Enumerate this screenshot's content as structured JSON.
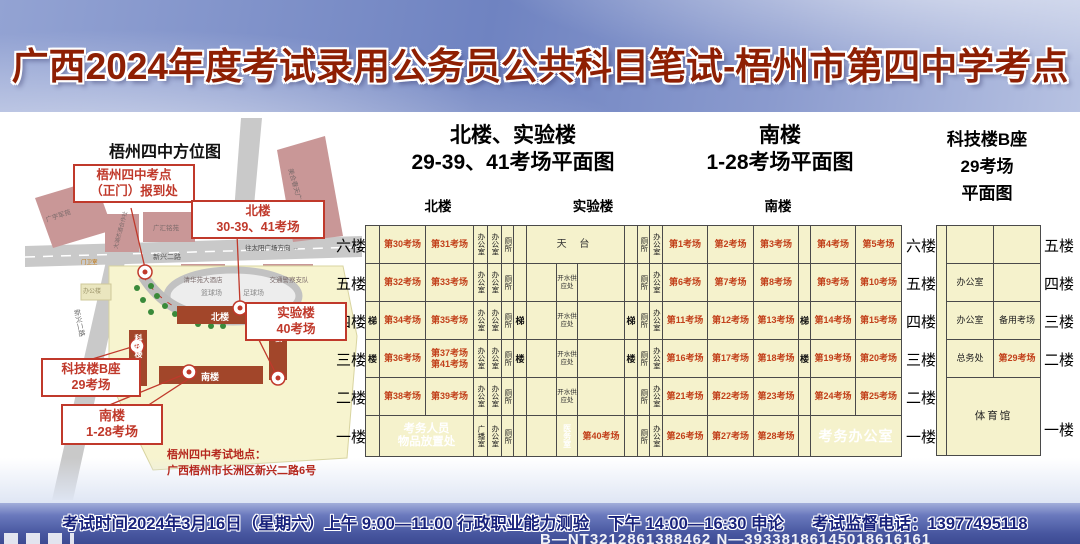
{
  "title": "广西2024年度考试录用公务员公共科目笔试-梧州市第四中学考点",
  "colors": {
    "banner_blue": "#6f83c1",
    "title_red": "#8e1f03",
    "cell_yellow": "#f5f2cc",
    "stair_green": "#d6e04e",
    "room_orange": "#c2401a",
    "admin_red": "#a2462a",
    "footer_blue": "#47569f",
    "callout_red": "#c0392b"
  },
  "map": {
    "title": "梧州四中方位图",
    "callouts": {
      "gate": {
        "l1": "梧州四中考点",
        "l2": "（正门）报到处"
      },
      "north": {
        "l1": "北楼",
        "l2": "30-39、41考场"
      },
      "lab": {
        "l1": "实验楼",
        "l2": "40考场"
      },
      "tech": {
        "l1": "科技楼B座",
        "l2": "29考场"
      },
      "south": {
        "l1": "南楼",
        "l2": "1-28考场"
      }
    },
    "buildings": {
      "b1": "广宇军苑",
      "b2": "大湖杰酒合作社",
      "b3": "广汇铭苑",
      "b4": "美合春天广场",
      "b5": "清华苑大酒店",
      "b6": "交通警察支队"
    },
    "campus": {
      "north": "北楼",
      "lab": "实验楼",
      "south": "南楼",
      "tech": "科技楼",
      "office": "办公楼",
      "gatehouse": "门卫室",
      "basketball": "篮球场",
      "football": "足球场"
    },
    "roads": {
      "r1": "新兴二路",
      "r2": "新兴二路",
      "r3": "往太阳广场方向",
      "arrow": "→"
    },
    "address": {
      "l1": "梧州四中考试地点：",
      "l2": "广西梧州市长洲区新兴二路6号"
    }
  },
  "plans": {
    "north_lab": {
      "line1": "北楼、实验楼",
      "line2": "29-39、41考场平面图",
      "sub_left": "北楼",
      "sub_right": "实验楼"
    },
    "south": {
      "line1": "南楼",
      "line2": "1-28考场平面图",
      "sub": "南楼"
    },
    "tech": {
      "line1": "科技楼B座",
      "line2": "29考场",
      "line3": "平面图"
    }
  },
  "floors": {
    "main": [
      "六楼",
      "五楼",
      "四楼",
      "三楼",
      "二楼",
      "一楼"
    ],
    "tech": [
      "五楼",
      "四楼",
      "三楼",
      "二楼",
      "一楼"
    ]
  },
  "strip": {
    "col_widths": [
      14,
      46,
      48,
      14,
      14,
      12,
      13,
      30,
      21,
      47,
      13,
      12,
      13,
      45,
      46,
      45,
      12,
      45,
      46
    ],
    "row_heights": [
      38,
      38,
      38,
      38,
      38,
      41
    ],
    "rows": [
      {
        "label": "六楼",
        "cells": [
          {
            "k": "st"
          },
          {
            "k": "room",
            "t": "第30考场"
          },
          {
            "k": "room",
            "t": "第31考场"
          },
          {
            "k": "v",
            "t": "办公室"
          },
          {
            "k": "v",
            "t": "办公室"
          },
          {
            "k": "v",
            "t": "厕所"
          },
          {
            "k": "st"
          },
          {
            "k": "terr",
            "t": "天 台",
            "cs": 3
          },
          {
            "k": "st"
          },
          {
            "k": "v",
            "t": "厕所"
          },
          {
            "k": "v",
            "t": "办公室"
          },
          {
            "k": "room",
            "t": "第1考场"
          },
          {
            "k": "room",
            "t": "第2考场"
          },
          {
            "k": "room",
            "t": "第3考场"
          },
          {
            "k": "st"
          },
          {
            "k": "room",
            "t": "第4考场"
          },
          {
            "k": "room",
            "t": "第5考场"
          }
        ]
      },
      {
        "label": "五楼",
        "cells": [
          {
            "k": "st"
          },
          {
            "k": "room",
            "t": "第32考场"
          },
          {
            "k": "room",
            "t": "第33考场"
          },
          {
            "k": "v",
            "t": "办公室"
          },
          {
            "k": "v",
            "t": "办公室"
          },
          {
            "k": "v",
            "t": "厕所"
          },
          {
            "k": "st"
          },
          {
            "k": "blank"
          },
          {
            "k": "small",
            "t": "开水供\n应处"
          },
          {
            "k": "blank"
          },
          {
            "k": "st"
          },
          {
            "k": "v",
            "t": "厕所"
          },
          {
            "k": "v",
            "t": "办公室"
          },
          {
            "k": "room",
            "t": "第6考场"
          },
          {
            "k": "room",
            "t": "第7考场"
          },
          {
            "k": "room",
            "t": "第8考场"
          },
          {
            "k": "st"
          },
          {
            "k": "room",
            "t": "第9考场"
          },
          {
            "k": "room",
            "t": "第10考场"
          }
        ]
      },
      {
        "label": "四楼",
        "cells": [
          {
            "k": "st",
            "ch": "梯"
          },
          {
            "k": "room",
            "t": "第34考场"
          },
          {
            "k": "room",
            "t": "第35考场"
          },
          {
            "k": "v",
            "t": "办公室"
          },
          {
            "k": "v",
            "t": "办公室"
          },
          {
            "k": "v",
            "t": "厕所"
          },
          {
            "k": "st",
            "ch": "梯"
          },
          {
            "k": "blank"
          },
          {
            "k": "small",
            "t": "开水供\n应处"
          },
          {
            "k": "blank"
          },
          {
            "k": "st",
            "ch": "梯"
          },
          {
            "k": "v",
            "t": "厕所"
          },
          {
            "k": "v",
            "t": "办公室"
          },
          {
            "k": "room",
            "t": "第11考场"
          },
          {
            "k": "room",
            "t": "第12考场"
          },
          {
            "k": "room",
            "t": "第13考场"
          },
          {
            "k": "st",
            "ch": "梯"
          },
          {
            "k": "room",
            "t": "第14考场"
          },
          {
            "k": "room",
            "t": "第15考场"
          }
        ]
      },
      {
        "label": "三楼",
        "cells": [
          {
            "k": "st",
            "ch": "楼"
          },
          {
            "k": "room",
            "t": "第36考场"
          },
          {
            "k": "room",
            "t": "第37考场\n第41考场"
          },
          {
            "k": "v",
            "t": "办公室"
          },
          {
            "k": "v",
            "t": "办公室"
          },
          {
            "k": "v",
            "t": "厕所"
          },
          {
            "k": "st",
            "ch": "楼"
          },
          {
            "k": "blank"
          },
          {
            "k": "small",
            "t": "开水供\n应处"
          },
          {
            "k": "blank"
          },
          {
            "k": "st",
            "ch": "楼"
          },
          {
            "k": "v",
            "t": "厕所"
          },
          {
            "k": "v",
            "t": "办公室"
          },
          {
            "k": "room",
            "t": "第16考场"
          },
          {
            "k": "room",
            "t": "第17考场"
          },
          {
            "k": "room",
            "t": "第18考场"
          },
          {
            "k": "st",
            "ch": "楼"
          },
          {
            "k": "room",
            "t": "第19考场"
          },
          {
            "k": "room",
            "t": "第20考场"
          }
        ]
      },
      {
        "label": "二楼",
        "cells": [
          {
            "k": "st"
          },
          {
            "k": "room",
            "t": "第38考场"
          },
          {
            "k": "room",
            "t": "第39考场"
          },
          {
            "k": "v",
            "t": "办公室"
          },
          {
            "k": "v",
            "t": "办公室"
          },
          {
            "k": "v",
            "t": "厕所"
          },
          {
            "k": "st"
          },
          {
            "k": "blank"
          },
          {
            "k": "small",
            "t": "开水供\n应处"
          },
          {
            "k": "blank"
          },
          {
            "k": "st"
          },
          {
            "k": "v",
            "t": "厕所"
          },
          {
            "k": "v",
            "t": "办公室"
          },
          {
            "k": "room",
            "t": "第21考场"
          },
          {
            "k": "room",
            "t": "第22考场"
          },
          {
            "k": "room",
            "t": "第23考场"
          },
          {
            "k": "st"
          },
          {
            "k": "room",
            "t": "第24考场"
          },
          {
            "k": "room",
            "t": "第25考场"
          }
        ]
      },
      {
        "label": "一楼",
        "cells": [
          {
            "k": "st"
          },
          {
            "k": "dark",
            "t": "考务人员\n物品放置处",
            "cs": 2
          },
          {
            "k": "v",
            "t": "广播室"
          },
          {
            "k": "v",
            "t": "办公室"
          },
          {
            "k": "v",
            "t": "厕所"
          },
          {
            "k": "st"
          },
          {
            "k": "blank"
          },
          {
            "k": "vd",
            "t": "医务室"
          },
          {
            "k": "room",
            "t": "第40考场"
          },
          {
            "k": "st"
          },
          {
            "k": "v",
            "t": "厕所"
          },
          {
            "k": "v",
            "t": "办公室"
          },
          {
            "k": "room",
            "t": "第26考场"
          },
          {
            "k": "room",
            "t": "第27考场"
          },
          {
            "k": "room",
            "t": "第28考场"
          },
          {
            "k": "st"
          },
          {
            "k": "darkbig",
            "t": "考务办公室",
            "cs": 2
          }
        ]
      }
    ]
  },
  "tech_table": {
    "col_widths": [
      10,
      47,
      47
    ],
    "row_heights": [
      38,
      38,
      38,
      38,
      78
    ],
    "rows": [
      {
        "label": "五楼",
        "cells": [
          {
            "k": "blank",
            "rs": 5
          },
          {
            "k": "blank"
          },
          {
            "k": "blank"
          }
        ]
      },
      {
        "label": "四楼",
        "cells": [
          {
            "k": "off",
            "t": "办公室"
          },
          {
            "k": "blank"
          }
        ]
      },
      {
        "label": "三楼",
        "cells": [
          {
            "k": "off",
            "t": "办公室"
          },
          {
            "k": "off",
            "t": "备用考场"
          }
        ]
      },
      {
        "label": "二楼",
        "cells": [
          {
            "k": "off",
            "t": "总务处"
          },
          {
            "k": "room",
            "t": "第29考场"
          }
        ]
      },
      {
        "label": "一楼",
        "cells": [
          {
            "k": "gym",
            "t": "体育馆",
            "cs": 2
          }
        ]
      }
    ]
  },
  "footer": {
    "seg1": "考试时间2024年3月16日（星期六）上午 9:00—11:00 行政职业能力测验",
    "seg2": "下午 14:00—16:30 申论",
    "seg3": "考试监督电话：13977495118",
    "watermark": "B—NT3212861388462 N—39338186145018616161"
  }
}
